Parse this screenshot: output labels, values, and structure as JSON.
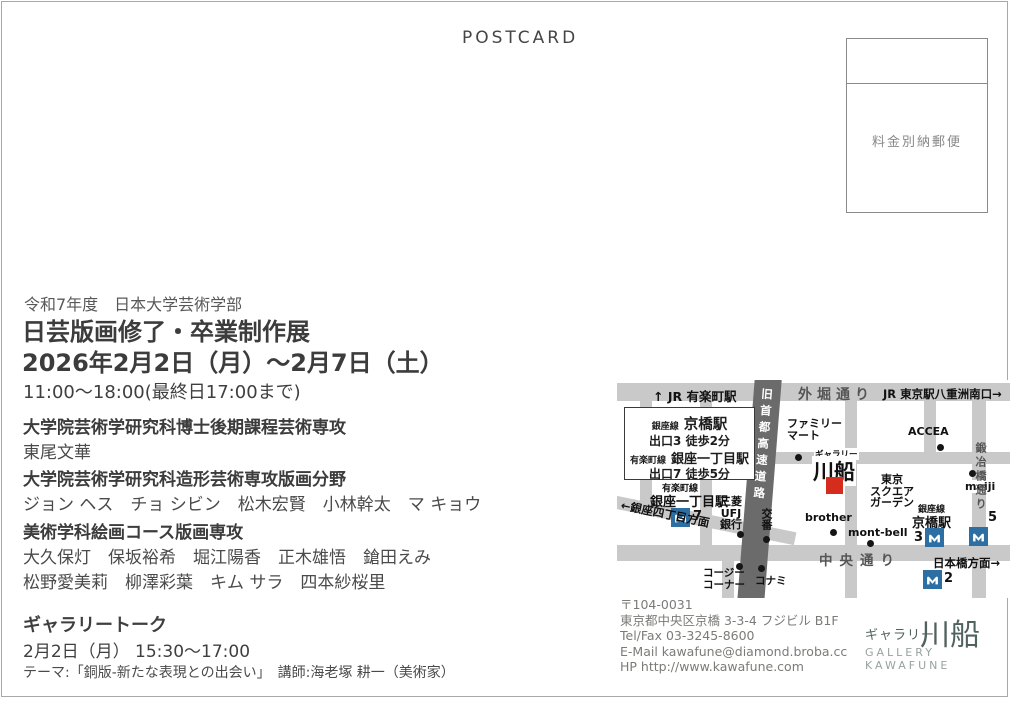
{
  "postcard_label": "POSTCARD",
  "stamp_box": {
    "label": "料金別納郵便"
  },
  "event": {
    "era_line": "令和7年度　日本大学芸術学部",
    "title": "日芸版画修了・卒業制作展",
    "dates": "2026年2月2日（月）～2月7日（土）",
    "hours": "11:00～18:00(最終日17:00まで)",
    "sections": [
      {
        "heading": "大学院芸術学研究科博士後期課程芸術専攻",
        "lines": [
          "東尾文華"
        ]
      },
      {
        "heading": "大学院芸術学研究科造形芸術専攻版画分野",
        "lines": [
          "ジョン ヘス　チョ シビン　松木宏賢　小林幹太　マ キョウ"
        ]
      },
      {
        "heading": "美術学科絵画コース版画専攻",
        "lines": [
          "大久保灯　保坂裕希　堀江陽香　正木雄悟　鎗田えみ",
          "松野愛美莉　柳澤彩葉　キム サラ　四本紗桜里"
        ]
      }
    ],
    "gallery_talk": {
      "heading": "ギャラリートーク",
      "datetime": "2月2日（月） 15:30～17:00",
      "theme": "テーマ:「銅版-新たな表現との出会い」　講師:海老塚 耕一（美術家）"
    }
  },
  "map": {
    "top_road": {
      "left_label": "↑ JR 有楽町駅",
      "center_label": "外堀通り",
      "right_label": "JR 東京駅八重洲南口→"
    },
    "expressway_label": "旧首都高速道路",
    "access_box": {
      "station1_line": "銀座線",
      "station1_name": "京橋駅",
      "station1_exit": "出口3 徒歩2分",
      "station2_line": "有楽町線",
      "station2_name": "銀座一丁目駅",
      "station2_exit": "出口7 徒歩5分"
    },
    "gallery_marker": {
      "small": "ギャラリー",
      "large": "川船"
    },
    "stations": {
      "ginza_itchome": {
        "line": "有楽町線",
        "name": "銀座一丁目駅",
        "exit": "7"
      },
      "kyobashi": {
        "line": "銀座線",
        "name": "京橋駅",
        "exit3": "3",
        "exit5": "5",
        "exit2": "2"
      }
    },
    "pois": {
      "familymart": [
        "ファミリー",
        "マート"
      ],
      "accea": "ACCEA",
      "meiji": "meiji",
      "mitsubishi": [
        "三菱",
        "UFJ",
        "銀行"
      ],
      "koban": "交番",
      "brother": "brother",
      "montbell": "mont-bell",
      "square_garden": [
        "東京",
        "スクエア",
        "ガーデン"
      ],
      "cozy_corner": [
        "コージー",
        "コーナー"
      ],
      "konami": "コナミ"
    },
    "road_labels": {
      "kajibashi": "鍛冶橋通り",
      "chuo": "中央通り",
      "ginza4": "←銀座四丁目方面",
      "nihonbashi": "日本橋方面→"
    }
  },
  "contact": {
    "postal": "〒104-0031",
    "address": "東京都中央区京橋 3-3-4 フジビル B1F",
    "tel": "Tel/Fax 03-3245-8600",
    "email": "E-Mail kawafune@diamond.broba.cc",
    "hp": "HP http://www.kawafune.com"
  },
  "logo": {
    "jp_small": "ギャラリー",
    "jp_large": "川船",
    "en": "GALLERY KAWAFUNE"
  },
  "colors": {
    "metro_blue": "#2e6fa3",
    "gallery_red": "#d62c1e",
    "road_gray": "#c9c9c9",
    "expressway_gray": "#6b6b6b",
    "logo_teal": "#50625f"
  }
}
